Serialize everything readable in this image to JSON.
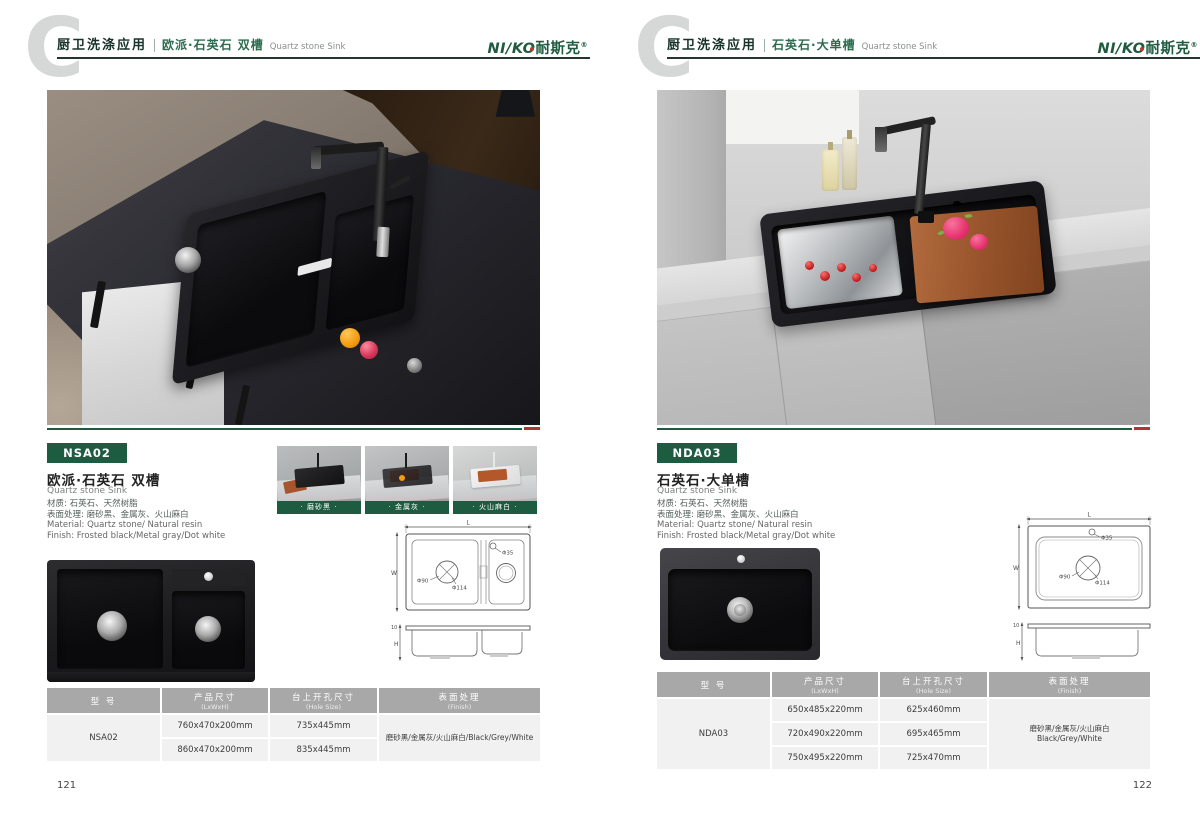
{
  "colors": {
    "accent_green": "#1d5c40",
    "accent_red": "#b5342c",
    "logo_green": "#1e5b40",
    "table_header_gray": "#a8a8a8",
    "table_row_gray": "#f1f1f1"
  },
  "brand": {
    "logo_en": "NI/KO",
    "logo_cn": "耐斯克",
    "reg": "®"
  },
  "pages": [
    {
      "page_number": "121",
      "header": {
        "category": "厨卫洗涤应用",
        "series": "欧派·石英石 双槽",
        "series_en": "Quartz stone Sink"
      },
      "model": "NSA02",
      "title": "欧派·石英石 双槽",
      "title_en": "Quartz stone Sink",
      "specs": {
        "cn1": "材质: 石英石、天然树脂",
        "cn2": "表面处理: 磨砂黑、金属灰、火山麻白",
        "en1": "Material: Quartz stone/ Natural resin",
        "en2": "Finish: Frosted black/Metal gray/Dot white"
      },
      "swatches": [
        {
          "label": "· 磨砂黑 ·"
        },
        {
          "label": "· 金属灰 ·"
        },
        {
          "label": "· 火山麻白 ·"
        }
      ],
      "drawing": {
        "L": "L",
        "W": "W",
        "phi35": "Φ35",
        "phi90": "Φ90",
        "phi114": "Φ114",
        "thickness": "10",
        "H": "H"
      },
      "table": {
        "col_model": "型 号",
        "col_size": "产品尺寸",
        "col_size_en": "(LxWxH)",
        "col_hole": "台上开孔尺寸",
        "col_hole_en": "(Hole Size)",
        "col_finish": "表面处理",
        "col_finish_en": "(Finish)",
        "model": "NSA02",
        "sizes": [
          "760x470x200mm",
          "860x470x200mm"
        ],
        "holes": [
          "735x445mm",
          "835x445mm"
        ],
        "finish_lines": [
          "磨砂黑/金属灰/火山麻白/Black/Grey/White"
        ]
      }
    },
    {
      "page_number": "122",
      "header": {
        "category": "厨卫洗涤应用",
        "series": "石英石·大单槽",
        "series_en": "Quartz stone Sink"
      },
      "model": "NDA03",
      "title": "石英石·大单槽",
      "title_en": "Quartz stone Sink",
      "specs": {
        "cn1": "材质: 石英石、天然树脂",
        "cn2": "表面处理: 磨砂黑、金属灰、火山麻白",
        "en1": "Material: Quartz stone/ Natural resin",
        "en2": "Finish: Frosted black/Metal gray/Dot white"
      },
      "drawing": {
        "L": "L",
        "W": "W",
        "phi35": "Φ35",
        "phi90": "Φ90",
        "phi114": "Φ114",
        "thickness": "10",
        "H": "H"
      },
      "table": {
        "col_model": "型 号",
        "col_size": "产品尺寸",
        "col_size_en": "(LxWxH)",
        "col_hole": "台上开孔尺寸",
        "col_hole_en": "(Hole Size)",
        "col_finish": "表面处理",
        "col_finish_en": "(Finish)",
        "model": "NDA03",
        "sizes": [
          "650x485x220mm",
          "720x490x220mm",
          "750x495x220mm"
        ],
        "holes": [
          "625x460mm",
          "695x465mm",
          "725x470mm"
        ],
        "finish_lines": [
          "磨砂黑/金属灰/火山麻白",
          "Black/Grey/White"
        ]
      }
    }
  ]
}
